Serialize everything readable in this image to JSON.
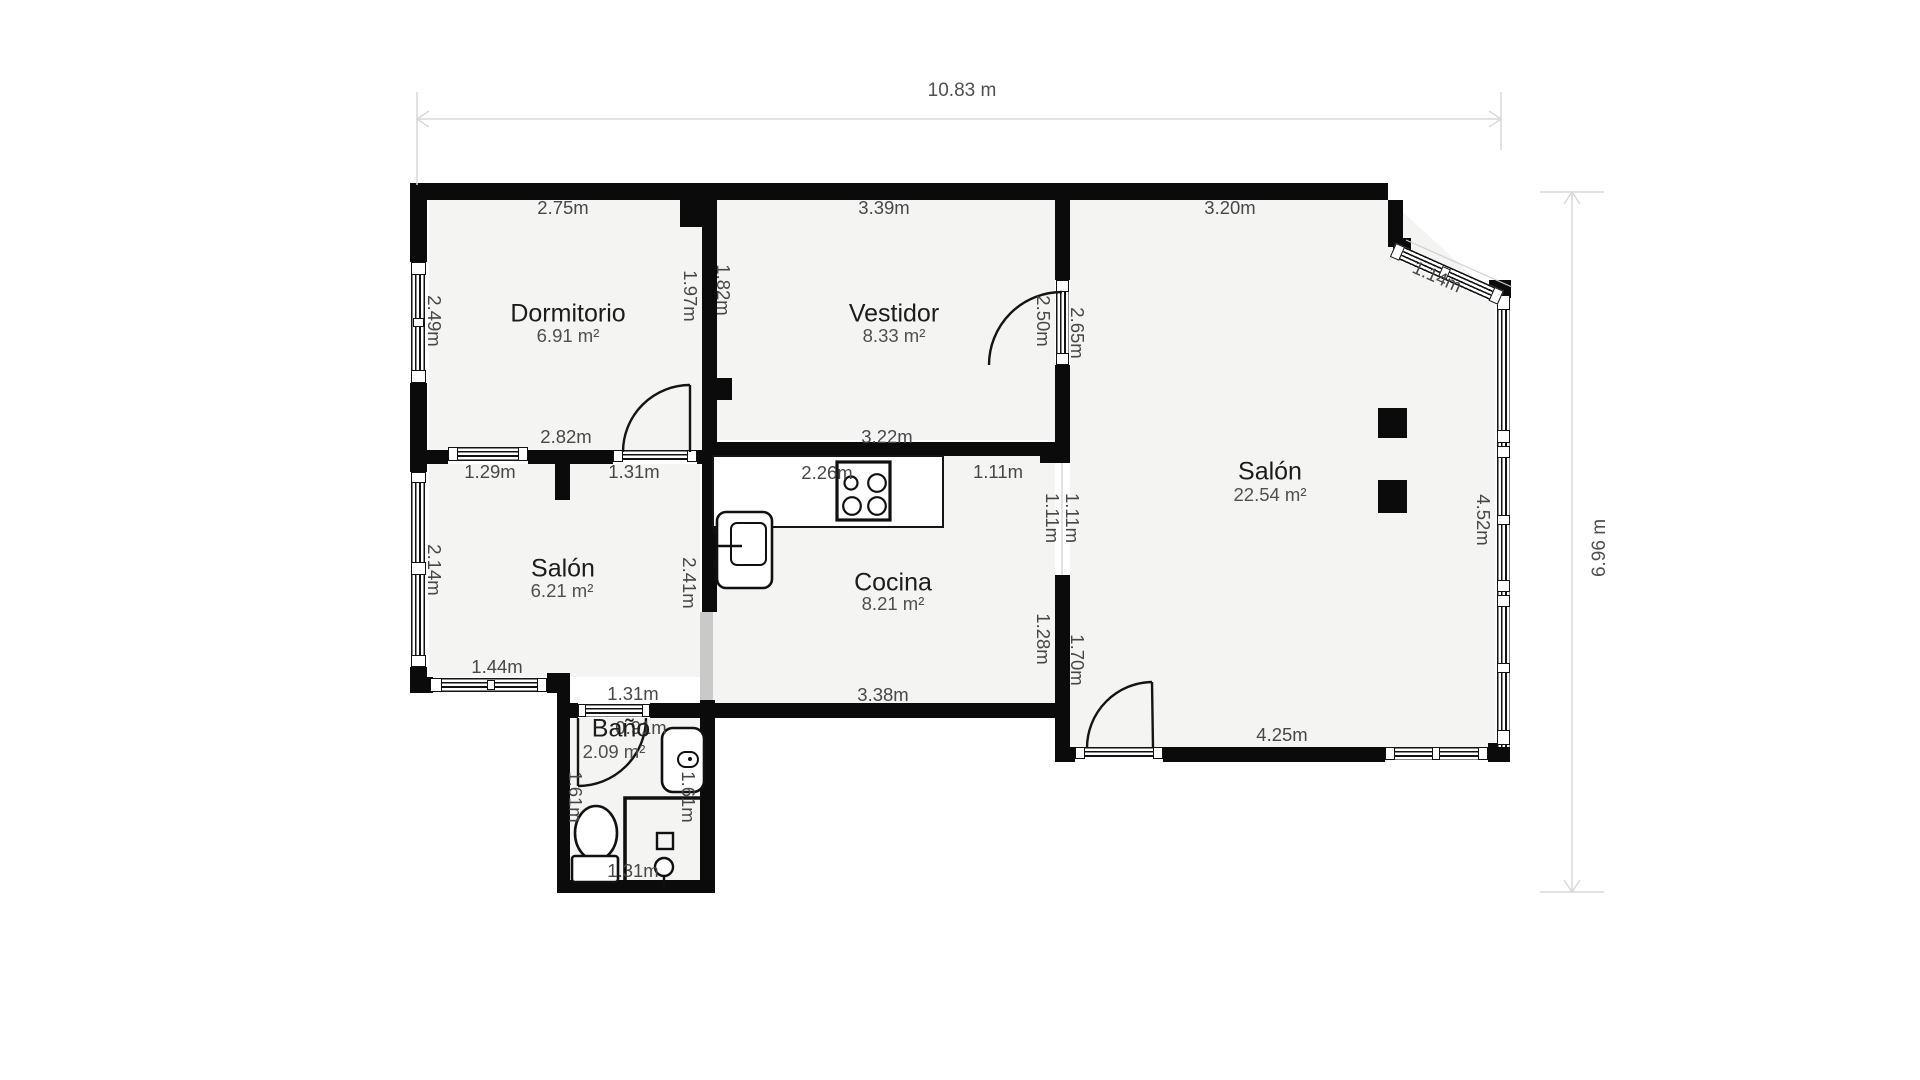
{
  "overall_dimensions": {
    "width": "10.83 m",
    "height": "6.96 m"
  },
  "rooms": [
    {
      "name": "Dormitorio",
      "area": "6.91 m²"
    },
    {
      "name": "Vestidor",
      "area": "8.33 m²"
    },
    {
      "name": "Salón",
      "area": "22.54 m²"
    },
    {
      "name": "Salón",
      "area": "6.21 m²"
    },
    {
      "name": "Cocina",
      "area": "8.21 m²"
    },
    {
      "name": "Baño",
      "area": "2.09 m²"
    }
  ],
  "measurements": {
    "dormitorio_top": "2.75m",
    "dormitorio_left": "2.49m",
    "dormitorio_bottom": "2.82m",
    "dormitorio_right": "1.97m",
    "dividing_wall": "1.82m",
    "vestidor_top": "3.39m",
    "vestidor_bottom": "3.22m",
    "vestidor_right": "2.50m",
    "salon_wall_upper": "2.65m",
    "salon_top": "3.20m",
    "salon_diagonal": "1.14m",
    "salon_right": "4.52m",
    "salon_bottom": "4.25m",
    "salon_wall_lower": "1.70m",
    "cocina_wall": "1.28m",
    "opening_left": "1.11m",
    "opening_right": "1.11m",
    "cocina_opening_top": "1.11m",
    "cocina_top": "2.26m",
    "cocina_bottom": "3.38m",
    "salon2_window_top": "1.29m",
    "dormitorio_door": "1.31m",
    "salon2_left": "2.14m",
    "salon2_right": "2.41m",
    "salon2_bottom": "1.44m",
    "bano_top": "1.31m",
    "bano_door": "0.91m",
    "bano_left": "1.61m",
    "bano_right": "1.61m",
    "bano_bottom": "1.31m"
  },
  "colors": {
    "wall": "#0b0b0b",
    "room_fill": "#f4f4f3",
    "dimension_line": "#d9d9d9",
    "label_text": "#474747"
  }
}
